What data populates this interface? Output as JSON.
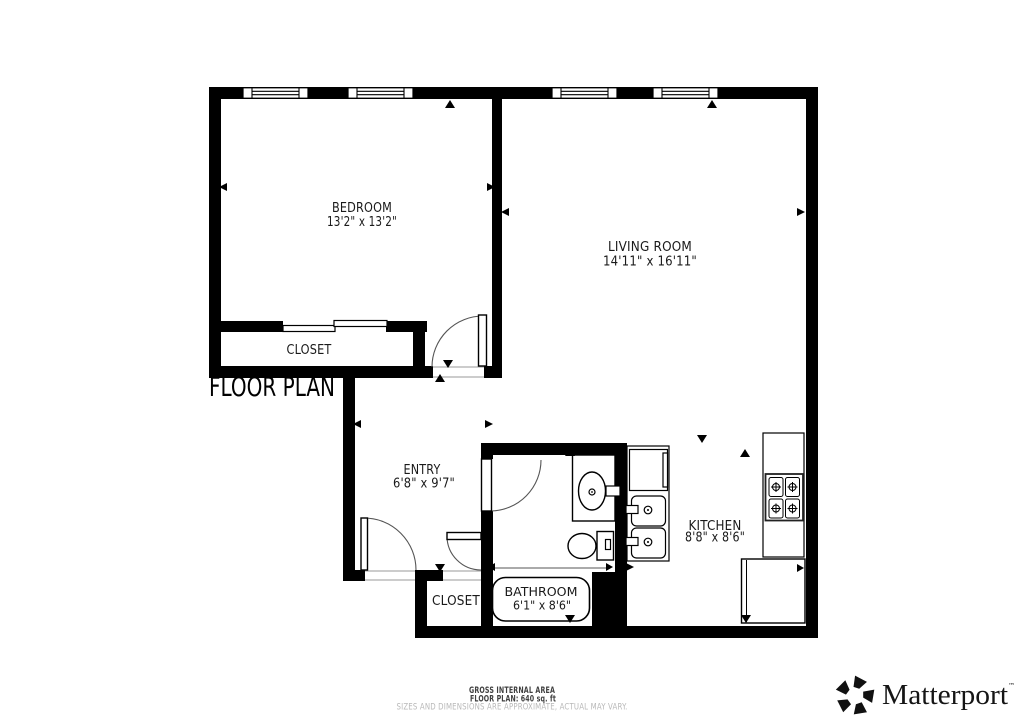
{
  "title": "FLOOR PLAN",
  "rooms": {
    "bedroom": {
      "name": "BEDROOM",
      "dims": "13'2\" x 13'2\""
    },
    "living_room": {
      "name": "LIVING ROOM",
      "dims": "14'11\" x 16'11\""
    },
    "bedroom_closet": {
      "name": "CLOSET"
    },
    "entry": {
      "name": "ENTRY",
      "dims": "6'8\" x 9'7\""
    },
    "bathroom": {
      "name": "BATHROOM",
      "dims": "6'1\" x 8'6\""
    },
    "entry_closet": {
      "name": "CLOSET"
    },
    "kitchen": {
      "name": "KITCHEN",
      "dims": "8'8\" x 8'6\""
    }
  },
  "footer": {
    "area_label": "GROSS INTERNAL AREA",
    "area_value": "FLOOR PLAN: 640 sq. ft",
    "disclaimer": "SIZES AND DIMENSIONS ARE APPROXIMATE, ACTUAL MAY VARY."
  },
  "brand": {
    "name": "Matterport",
    "trademark": "™"
  },
  "colors": {
    "wall": "#000000",
    "label": "#1a1a1a",
    "muted": "#b8b8b8",
    "footer_text": "#3f3f3f"
  }
}
